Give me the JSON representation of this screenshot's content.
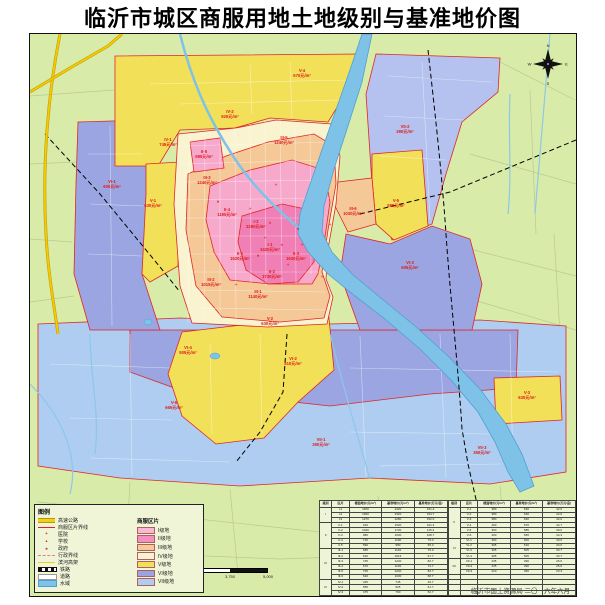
{
  "title": "临沂市城区商服用地土地级别与基准地价图",
  "credit": "临沂市国土资源局  二〇一六年六月",
  "map": {
    "compass": {
      "n": "N",
      "e": "E",
      "s": "S",
      "w": "W"
    },
    "labels": [
      {
        "id": "V-4",
        "price": "670元/m²",
        "x": 272,
        "y": 38
      },
      {
        "id": "IV-2",
        "price": "925元/m²",
        "x": 200,
        "y": 79
      },
      {
        "id": "III-5",
        "price": "1240元/m²",
        "x": 254,
        "y": 105
      },
      {
        "id": "IV-1",
        "price": "745元/m²",
        "x": 138,
        "y": 107
      },
      {
        "id": "II-5",
        "price": "980元/m²",
        "x": 174,
        "y": 119
      },
      {
        "id": "VI-1",
        "price": "600元/m²",
        "x": 82,
        "y": 149
      },
      {
        "id": "V-1",
        "price": "630元/m²",
        "x": 123,
        "y": 168
      },
      {
        "id": "III-3",
        "price": "1240元/m²",
        "x": 177,
        "y": 145
      },
      {
        "id": "VII-2",
        "price": "390元/m²",
        "x": 375,
        "y": 94
      },
      {
        "id": "III-6",
        "price": "1030元/m²",
        "x": 323,
        "y": 176
      },
      {
        "id": "V-5",
        "price": "585元/m²",
        "x": 366,
        "y": 168
      },
      {
        "id": "VI-3",
        "price": "505元/m²",
        "x": 380,
        "y": 230
      },
      {
        "id": "II-4",
        "price": "1190元/m²",
        "x": 197,
        "y": 177
      },
      {
        "id": "I-3",
        "price": "2280元/m²",
        "x": 226,
        "y": 189
      },
      {
        "id": "I-1",
        "price": "2420元/m²",
        "x": 240,
        "y": 212
      },
      {
        "id": "II-1",
        "price": "1520元/m²",
        "x": 210,
        "y": 221
      },
      {
        "id": "II-3",
        "price": "1630元/m²",
        "x": 266,
        "y": 221
      },
      {
        "id": "II-2",
        "price": "1730元/m²",
        "x": 242,
        "y": 239
      },
      {
        "id": "III-2",
        "price": "1015元/m²",
        "x": 181,
        "y": 247
      },
      {
        "id": "III-1",
        "price": "1140元/m²",
        "x": 228,
        "y": 259
      },
      {
        "id": "VI-4",
        "price": "505元/m²",
        "x": 158,
        "y": 315
      },
      {
        "id": "V-2",
        "price": "630元/m²",
        "x": 240,
        "y": 286
      },
      {
        "id": "VI-2",
        "price": "510元/m²",
        "x": 263,
        "y": 326
      },
      {
        "id": "V-6",
        "price": "665元/m²",
        "x": 144,
        "y": 370
      },
      {
        "id": "VII-1",
        "price": "390元/m²",
        "x": 291,
        "y": 407
      },
      {
        "id": "V-3",
        "price": "630元/m²",
        "x": 497,
        "y": 360
      },
      {
        "id": "VII-3",
        "price": "350元/m²",
        "x": 452,
        "y": 415
      }
    ]
  },
  "legend": {
    "title": "图例",
    "right_header": "商服区片",
    "line_items": [
      {
        "name": "highway",
        "label": "高速公路",
        "type": "line",
        "style": "yellow-thick"
      },
      {
        "name": "district-boundary",
        "label": "商服区片界线",
        "type": "line",
        "style": "red-line"
      },
      {
        "name": "hospital",
        "label": "医院",
        "type": "glyph",
        "glyph": "+",
        "size": "5px"
      },
      {
        "name": "school",
        "label": "学校",
        "type": "glyph",
        "glyph": "▲",
        "size": "3.5px"
      },
      {
        "name": "government",
        "label": "政府",
        "type": "glyph",
        "glyph": "★",
        "size": "4px"
      },
      {
        "name": "admin-boundary",
        "label": "行政界线",
        "type": "line",
        "style": "pink-dash"
      },
      {
        "name": "elevated-road",
        "label": "滨河高架",
        "type": "line",
        "style": "yellow-thin"
      },
      {
        "name": "railway",
        "label": "铁路",
        "type": "line",
        "style": "rail"
      },
      {
        "name": "road",
        "label": "道路",
        "type": "line",
        "style": "white-box"
      },
      {
        "name": "water",
        "label": "水域",
        "type": "line",
        "style": "blue-box"
      }
    ],
    "grades": [
      {
        "label": "I级地",
        "color": "#f9b9d0"
      },
      {
        "label": "II级地",
        "color": "#f58fc1"
      },
      {
        "label": "III级地",
        "color": "#f5c998"
      },
      {
        "label": "IV级地",
        "color": "#faf3cf"
      },
      {
        "label": "V级地",
        "color": "#f2e158"
      },
      {
        "label": "VI级地",
        "color": "#9aa4e2"
      },
      {
        "label": "VII级地",
        "color": "#aecdf0"
      }
    ]
  },
  "scalebar": {
    "labels": [
      "0",
      "625",
      "1,250",
      "2,500",
      "3,750",
      "5,000"
    ],
    "positions": [
      0,
      12.5,
      25,
      50,
      75,
      100
    ]
  },
  "table": {
    "headers": [
      "级别",
      "区片",
      "楼面地价(元/m²)",
      "基准地价(元/m²)",
      "基准地价(万元/亩)"
    ],
    "left_groups": [
      {
        "grade": "I",
        "rows": [
          [
            "I-1",
            "1450",
            "2420",
            "161.4"
          ],
          [
            "I-2",
            "1390",
            "2320",
            "154.7"
          ],
          [
            "I-3",
            "1370",
            "2280",
            "152.0"
          ]
        ]
      },
      {
        "grade": "II",
        "rows": [
          [
            "II-1",
            "910",
            "1520",
            "101.3"
          ],
          [
            "II-2",
            "1040",
            "1730",
            "115.3"
          ],
          [
            "II-3",
            "980",
            "1630",
            "108.7"
          ],
          [
            "II-4",
            "715",
            "1190",
            "79.3"
          ],
          [
            "II-5",
            "590",
            "980",
            "65.3"
          ]
        ]
      },
      {
        "grade": "III",
        "rows": [
          [
            "III-1",
            "685",
            "1140",
            "76.0"
          ],
          [
            "III-2",
            "610",
            "1015",
            "67.7"
          ],
          [
            "III-3",
            "745",
            "1240",
            "82.7"
          ],
          [
            "III-4",
            "670",
            "1120",
            "74.7"
          ],
          [
            "III-5",
            "745",
            "1240",
            "82.7"
          ],
          [
            "III-6",
            "620",
            "1030",
            "68.7"
          ]
        ]
      },
      {
        "grade": "IV",
        "rows": [
          [
            "IV-1",
            "445",
            "745",
            "49.7"
          ],
          [
            "IV-2",
            "555",
            "925",
            "61.7"
          ],
          [
            "IV-3",
            "475",
            "790",
            "52.7"
          ]
        ]
      }
    ],
    "right_groups": [
      {
        "grade": "V",
        "rows": [
          [
            "V-1",
            "380",
            "630",
            "42.0"
          ],
          [
            "V-2",
            "380",
            "630",
            "42.0"
          ],
          [
            "V-3",
            "380",
            "630",
            "42.0"
          ],
          [
            "V-4",
            "400",
            "670",
            "44.7"
          ],
          [
            "V-5",
            "350",
            "585",
            "39.0"
          ],
          [
            "V-6",
            "400",
            "665",
            "44.3"
          ]
        ]
      },
      {
        "grade": "VI",
        "rows": [
          [
            "VI-1",
            "360",
            "600",
            "40.0"
          ],
          [
            "VI-2",
            "305",
            "510",
            "34.0"
          ],
          [
            "VI-3",
            "305",
            "505",
            "33.7"
          ],
          [
            "VI-4",
            "305",
            "505",
            "33.7"
          ]
        ]
      },
      {
        "grade": "VII",
        "rows": [
          [
            "VII-1",
            "235",
            "390",
            "26.0"
          ],
          [
            "VII-2",
            "235",
            "390",
            "26.0"
          ],
          [
            "VII-3",
            "210",
            "350",
            "23.3"
          ]
        ]
      }
    ],
    "right_filler_rows": 4
  }
}
